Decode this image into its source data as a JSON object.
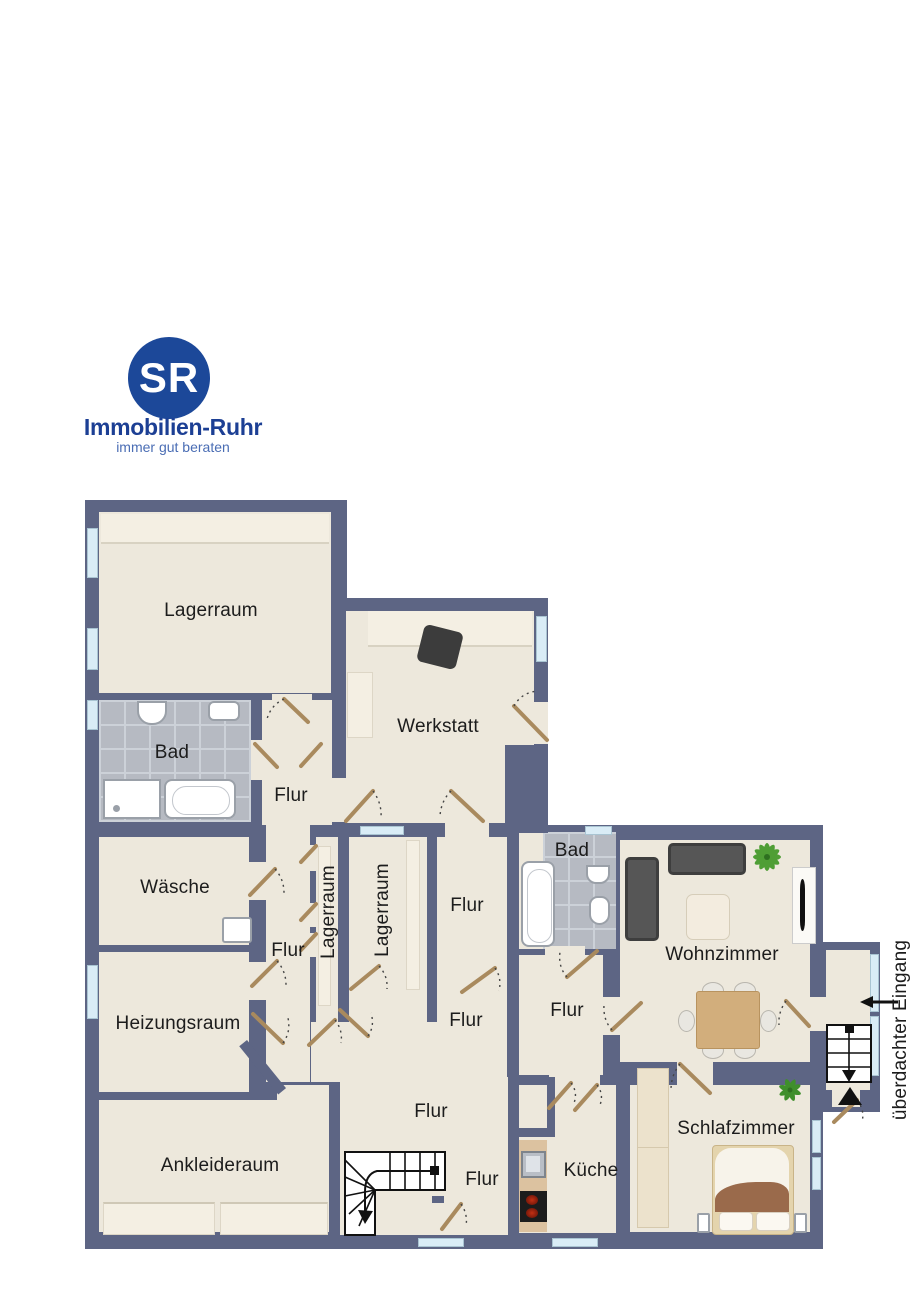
{
  "logo": {
    "initials": "SR",
    "company": "Immobilien-Ruhr",
    "tagline": "immer gut beraten"
  },
  "colors": {
    "wall": "#5d6584",
    "floor": "#ede8dc",
    "floor_light": "#f4efe3",
    "tile": "#b6bac2",
    "tile_grout": "#ccd1d8",
    "window": "#d9ecf6",
    "window_frame": "#a9c4d2",
    "door": "#a98a5e",
    "furniture_dark": "#4a4a4a",
    "wood": "#d2ae7c",
    "counter": "#dcc2a0",
    "blanket": "#9a6a4b",
    "bed_frame": "#e4d4ad",
    "plant": "#4f9e35",
    "stair": "#111111",
    "logo_blue": "#1c4899",
    "logo_text": "#1c3f94",
    "tagline": "#4a6db4",
    "label": "#1c1c1c"
  },
  "rooms": {
    "lagerraum_top": {
      "label": "Lagerraum"
    },
    "bad_top": {
      "label": "Bad"
    },
    "flur_top": {
      "label": "Flur"
    },
    "werkstatt": {
      "label": "Werkstatt"
    },
    "waesche": {
      "label": "Wäsche"
    },
    "lagerraum_narrow": {
      "label": "Lagerraum"
    },
    "lagerraum_mid": {
      "label": "Lagerraum"
    },
    "flur_mid": {
      "label": "Flur"
    },
    "bad_mid": {
      "label": "Bad"
    },
    "wohnzimmer": {
      "label": "Wohnzimmer"
    },
    "flur_corridor": {
      "label": "Flur"
    },
    "heizungsraum": {
      "label": "Heizungsraum"
    },
    "flur_center": {
      "label": "Flur"
    },
    "flur_small": {
      "label": "Flur"
    },
    "flur_bottom": {
      "label": "Flur"
    },
    "ankleideraum": {
      "label": "Ankleideraum"
    },
    "flur_stairs": {
      "label": "Flur"
    },
    "kueche": {
      "label": "Küche"
    },
    "schlafzimmer": {
      "label": "Schlafzimmer"
    },
    "eingang": {
      "label": "überdachter Eingang"
    }
  }
}
